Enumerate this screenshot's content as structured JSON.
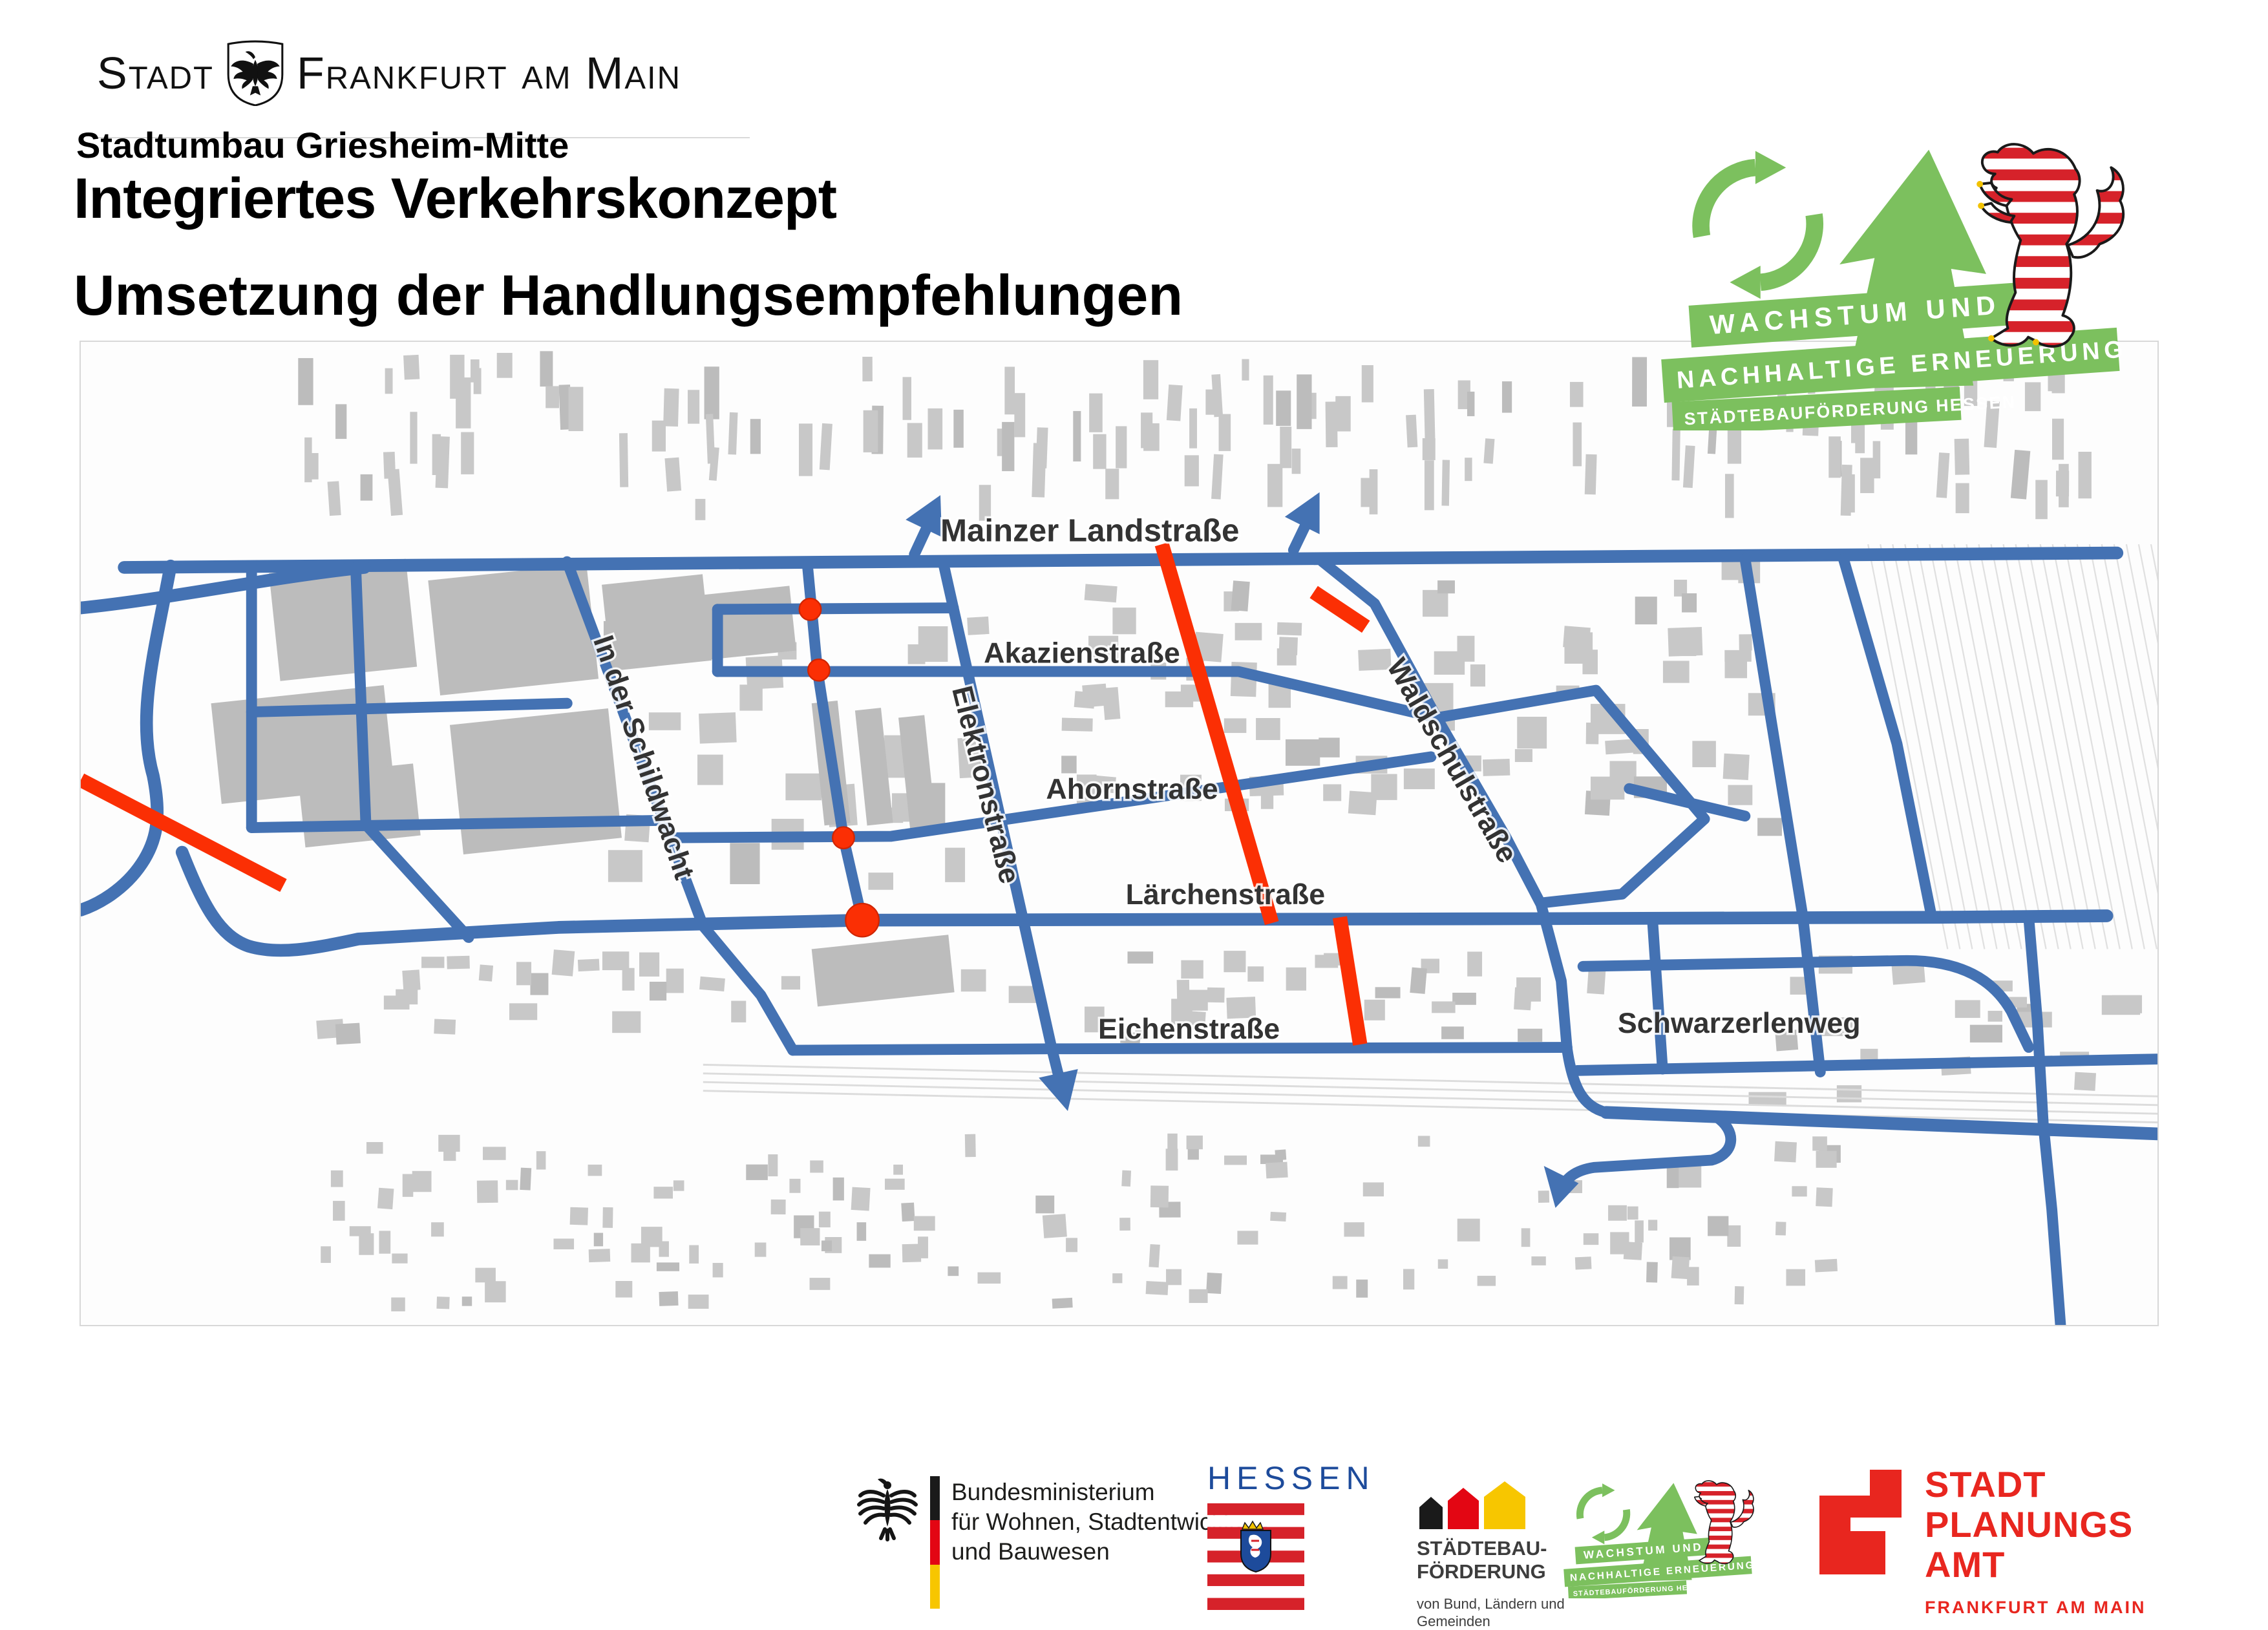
{
  "colors": {
    "road": "#4472b3",
    "highlight": "#fb2f04",
    "building": "#c8c8c8",
    "building-dark": "#bcbcbc",
    "label": "#333333",
    "green": "#7cc05e",
    "hessen-blue": "#1d4b9b",
    "amt-red": "#e8261f",
    "flag-red": "#d6222a",
    "gold": "#f2c200",
    "ink": "#1a1a1a"
  },
  "header": {
    "city_logo": {
      "word1": "Stadt",
      "word2": "Frankfurt am Main"
    },
    "kicker": "Stadtumbau Griesheim-Mitte",
    "title": "Integriertes Verkehrskonzept",
    "subtitle": "Umsetzung der Handlungsempfehlungen"
  },
  "growth_logo": {
    "line1": "WACHSTUM UND",
    "line2": "NACHHALTIGE ERNEUERUNG",
    "line3": "STÄDTEBAUFÖRDERUNG HESSEN"
  },
  "map": {
    "streets": {
      "mainzer": "Mainzer Landstraße",
      "akazien": "Akazienstraße",
      "schildwacht": "In der Schildwacht",
      "elektron": "Elektronstraße",
      "ahorn": "Ahornstraße",
      "waldschul": "Waldschulstraße",
      "laerchen": "Lärchenstraße",
      "eichen": "Eichenstraße",
      "schwarzerlen": "Schwarzerlenweg"
    }
  },
  "footer": {
    "bund": {
      "line1": "Bundesministerium",
      "line2": "für Wohnen, Stadtentwicklung",
      "line3": "und Bauwesen"
    },
    "hessen": {
      "wordmark": "HESSEN"
    },
    "staedtebau": {
      "line1": "STÄDTEBAU-",
      "line2": "FÖRDERUNG",
      "sub1": "von Bund, Ländern und",
      "sub2": "Gemeinden"
    },
    "growth": {
      "line1": "WACHSTUM UND",
      "line2": "NACHHALTIGE ERNEUERUNG",
      "line3": "STÄDTEBAUFÖRDERUNG HESSEN"
    },
    "planungsamt": {
      "line1": "STADT",
      "line2": "PLANUNGS",
      "line3": "AMT",
      "sub": "FRANKFURT AM MAIN"
    }
  }
}
